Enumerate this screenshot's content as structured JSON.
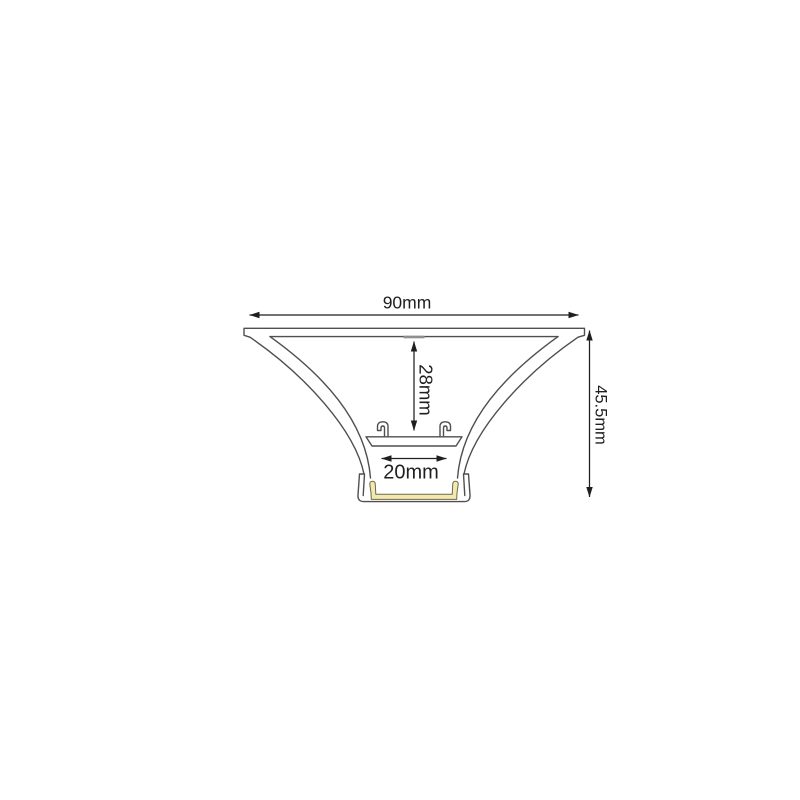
{
  "diagram": {
    "dimensions": {
      "width_total": "90mm",
      "inner_depth": "28mm",
      "channel_width": "20mm",
      "height_total": "45.5mm"
    },
    "colors": {
      "background": "#ffffff",
      "profile_line": "#4f4f4f",
      "dimension_line": "#1f1f1f",
      "led_strip_fill": "#f2e8b0",
      "led_strip_stroke": "#6e6a4a",
      "seam_mark": "#8f8f8f"
    }
  }
}
